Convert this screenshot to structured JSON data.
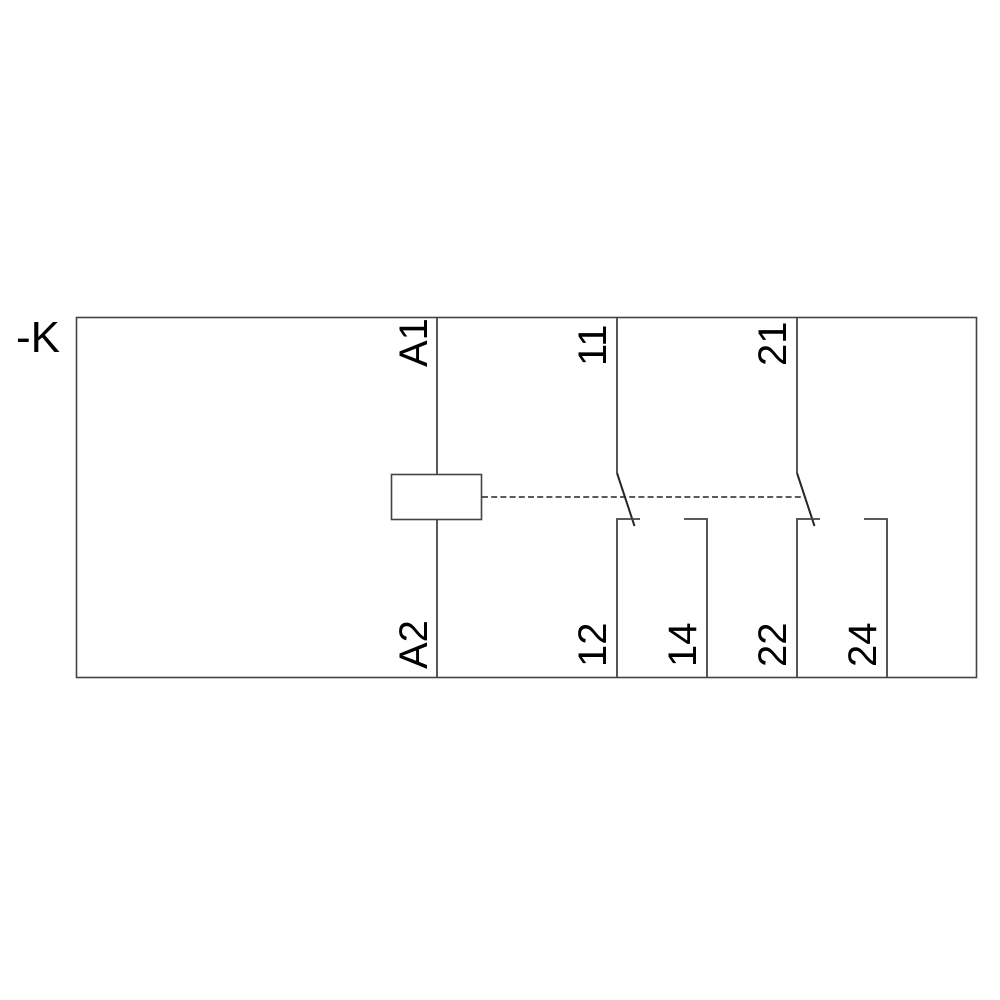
{
  "schematic": {
    "kind": "relay-circuit-diagram",
    "device_label": "-K",
    "coil": {
      "top_terminal": "A1",
      "bottom_terminal": "A2"
    },
    "contact1": {
      "type": "changeover",
      "common_terminal": "11",
      "nc_terminal": "12",
      "no_terminal": "14"
    },
    "contact2": {
      "type": "changeover",
      "common_terminal": "21",
      "nc_terminal": "22",
      "no_terminal": "24"
    },
    "colors": {
      "line": "#444444",
      "text": "#000000",
      "background": "#ffffff"
    }
  }
}
